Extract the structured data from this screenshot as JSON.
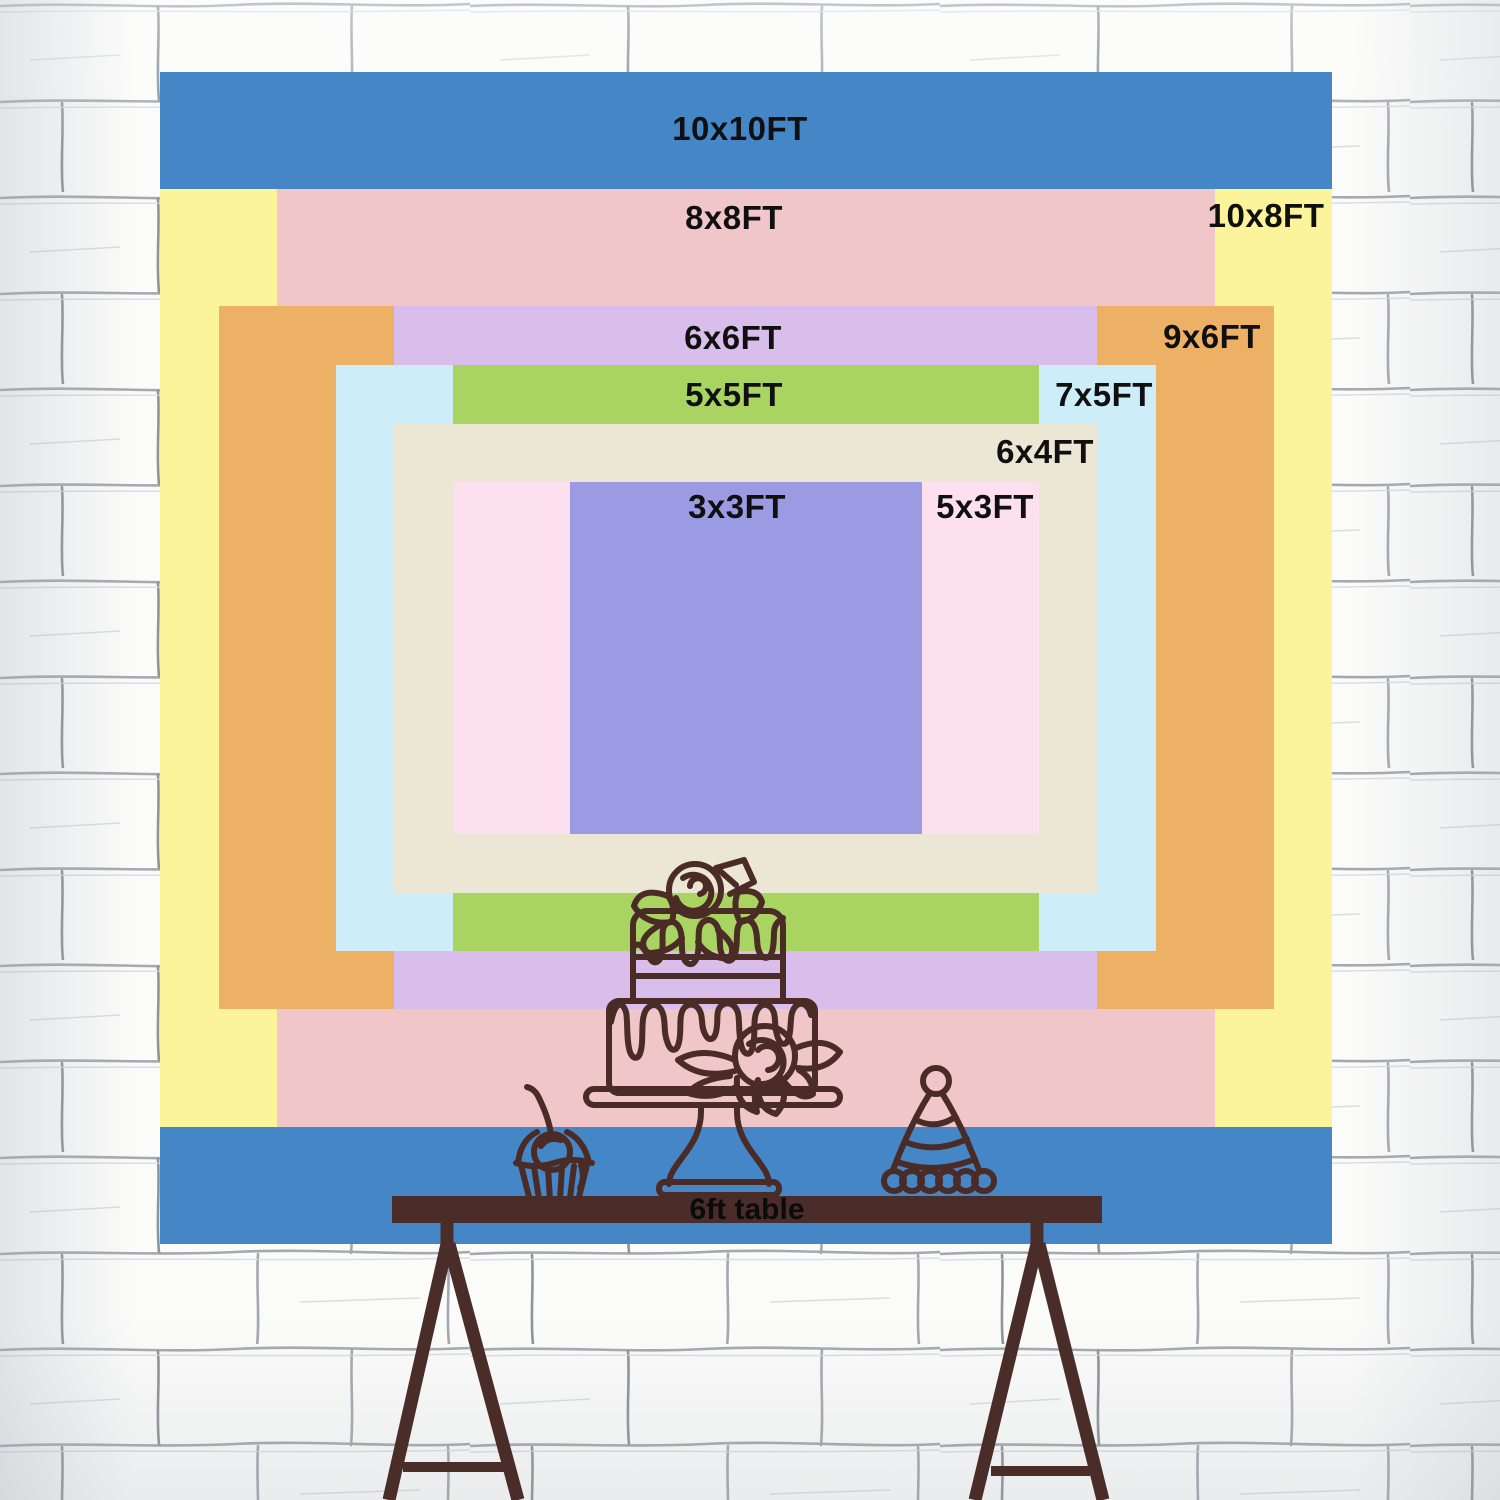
{
  "chart_data": {
    "type": "nested-rectangle-size-diagram",
    "unit": "FT",
    "sizes": [
      {
        "label": "10x10FT",
        "width_ft": 10,
        "height_ft": 10,
        "color": "#4587C6",
        "label_x": 740,
        "label_y": 129
      },
      {
        "label": "10x8FT",
        "width_ft": 10,
        "height_ft": 8,
        "color": "#FBF49B",
        "label_x": 1266,
        "label_y": 216
      },
      {
        "label": "8x8FT",
        "width_ft": 8,
        "height_ft": 8,
        "color": "#F1C6C8",
        "label_x": 734,
        "label_y": 218
      },
      {
        "label": "9x6FT",
        "width_ft": 9,
        "height_ft": 6,
        "color": "#EDB165",
        "label_x": 1212,
        "label_y": 337
      },
      {
        "label": "6x6FT",
        "width_ft": 6,
        "height_ft": 6,
        "color": "#D9BEEC",
        "label_x": 733,
        "label_y": 338
      },
      {
        "label": "7x5FT",
        "width_ft": 7,
        "height_ft": 5,
        "color": "#CDEEF9",
        "label_x": 1104,
        "label_y": 395
      },
      {
        "label": "5x5FT",
        "width_ft": 5,
        "height_ft": 5,
        "color": "#A9D462",
        "label_x": 734,
        "label_y": 395
      },
      {
        "label": "6x4FT",
        "width_ft": 6,
        "height_ft": 4,
        "color": "#ECE6D5",
        "label_x": 1045,
        "label_y": 452
      },
      {
        "label": "5x3FT",
        "width_ft": 5,
        "height_ft": 3,
        "color": "#FCE0EE",
        "label_x": 985,
        "label_y": 507
      },
      {
        "label": "3x3FT",
        "width_ft": 3,
        "height_ft": 3,
        "color": "#9A9BE2",
        "label_x": 737,
        "label_y": 507
      }
    ]
  },
  "table": {
    "label": "6ft table"
  },
  "decorations": {
    "cake": "two-tier-cake-with-roses-line-art",
    "cupcake": "cupcake-with-cherry-line-art",
    "hat": "party-hat-line-art",
    "wall": "white-painted-brick-wall"
  },
  "colors": {
    "table_bar": "#4A2C28",
    "line_art": "#4A2B26",
    "label_text": "#101010",
    "wall_base": "#FBFBFA",
    "wall_mortar": "#A3A9B1"
  }
}
